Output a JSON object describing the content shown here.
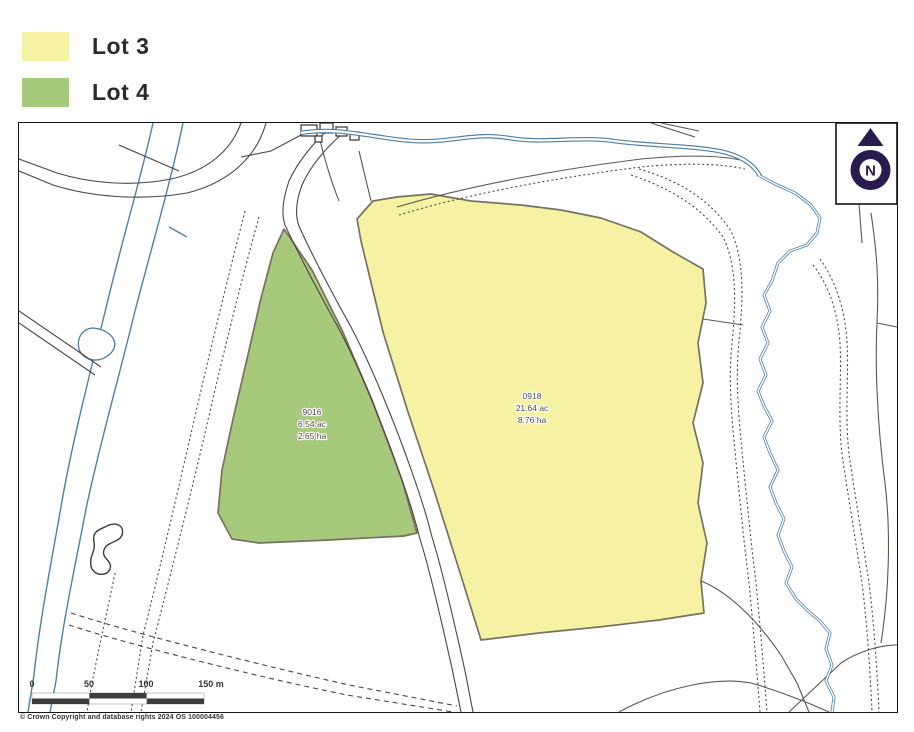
{
  "legend": {
    "items": [
      {
        "label": "Lot 3",
        "color": "#F6F2A3"
      },
      {
        "label": "Lot 4",
        "color": "#A6C97B"
      }
    ]
  },
  "map": {
    "lots": [
      {
        "legend_label": "Lot 3",
        "parcel_id": "0918",
        "area_acres": "21.64 ac",
        "area_hectares": "8.76 ha",
        "fill": "#F6F2A3"
      },
      {
        "legend_label": "Lot 4",
        "parcel_id": "9016",
        "area_acres": "6.54 ac",
        "area_hectares": "2.65 ha",
        "fill": "#A6C97B"
      }
    ],
    "compass": {
      "letter": "N",
      "color": "#2A1B4E"
    },
    "scale_bar": {
      "labels": [
        "0",
        "50",
        "100",
        "150 m"
      ],
      "bar_color": "#3D3D3D"
    },
    "colors": {
      "water": "#4F80A6",
      "field_boundary": "#5B574E",
      "lot_outline": "#76725F",
      "frame": "#141414"
    }
  },
  "footer": {
    "copyright": "© Crown Copyright and database rights 2024 OS 100004456"
  }
}
